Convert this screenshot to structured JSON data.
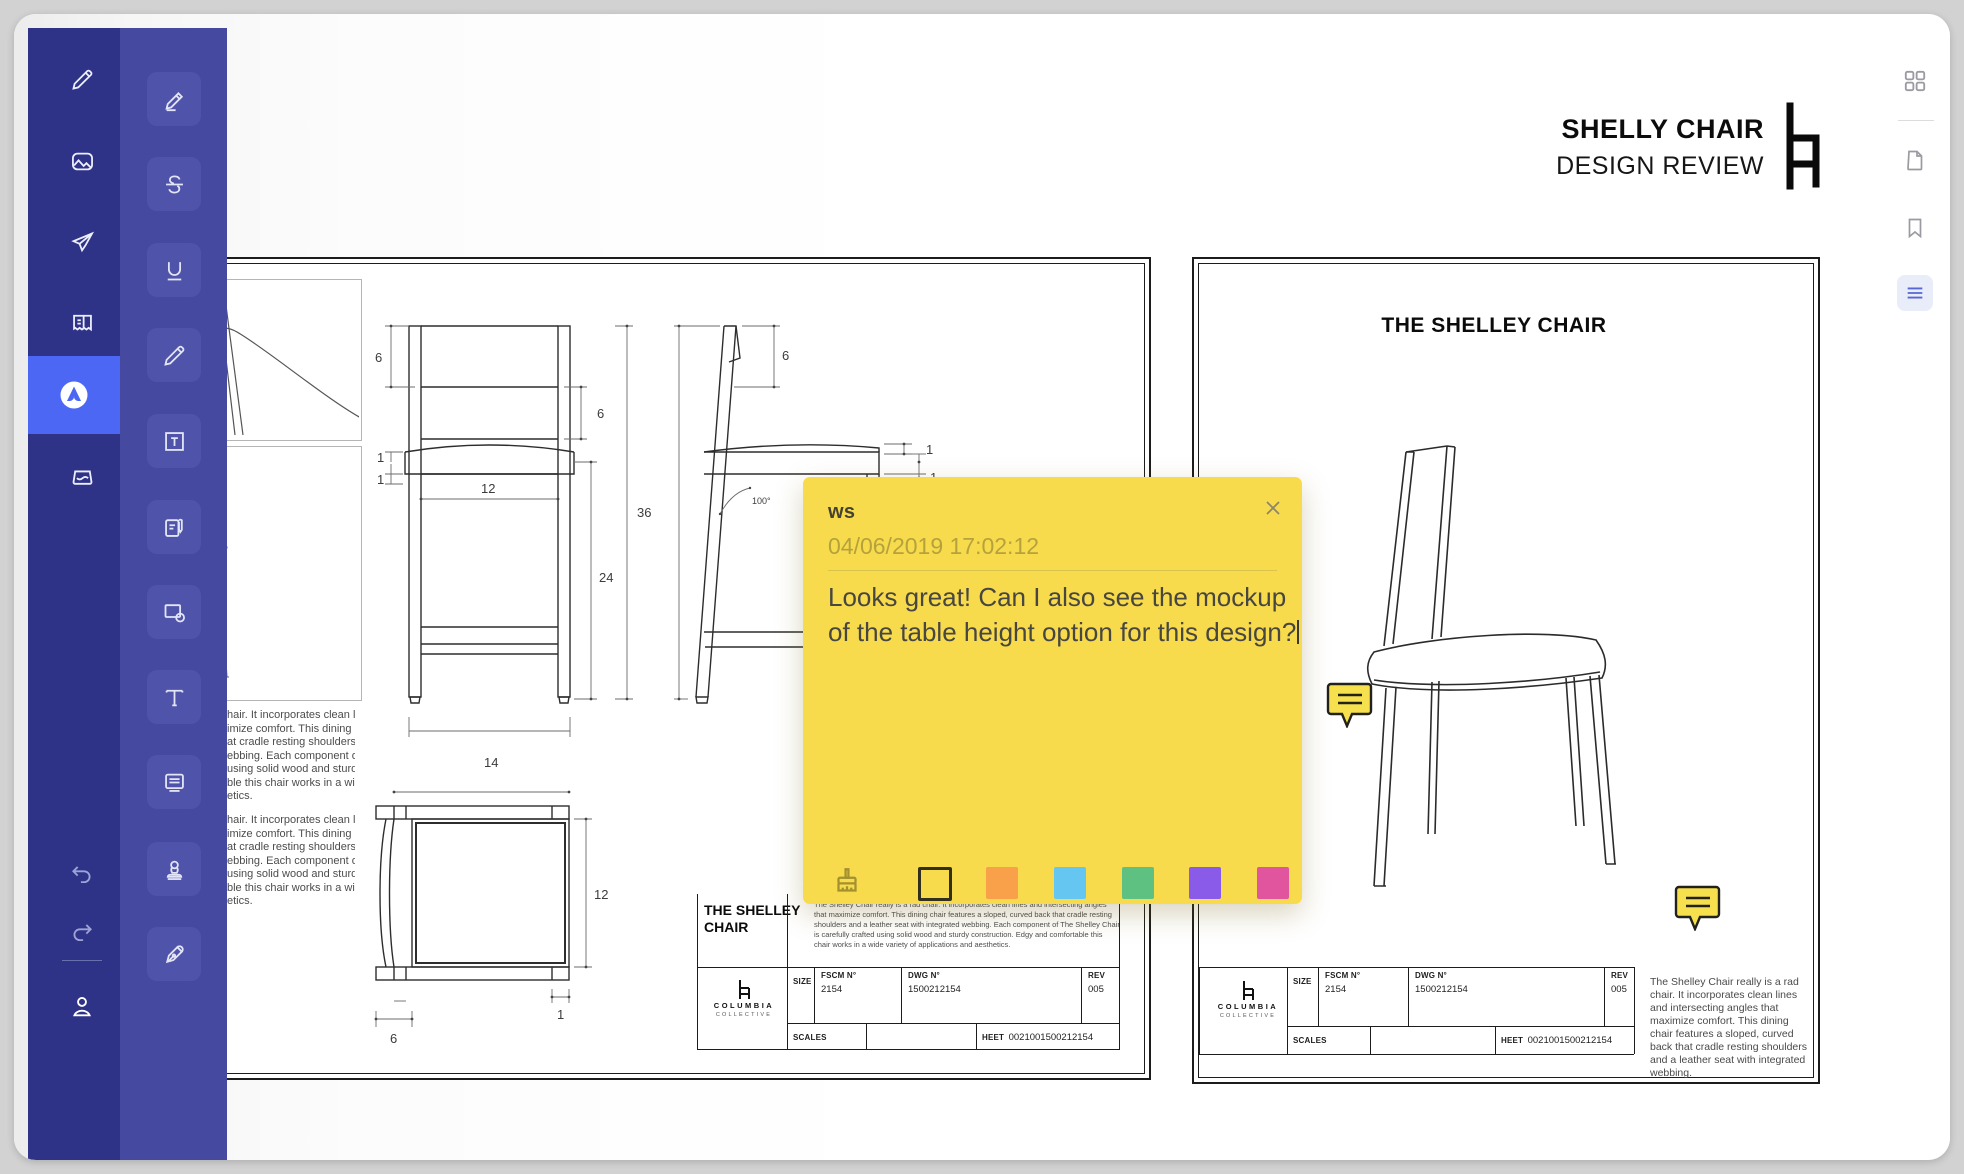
{
  "header": {
    "title": "SHELLY CHAIR",
    "subtitle": "DESIGN REVIEW"
  },
  "note": {
    "author": "ws",
    "timestamp": "04/06/2019 17:02:12",
    "body_line1": "Looks great! Can I also see the mockup",
    "body_line2": "of the table height option for this design?",
    "colors": {
      "note": "#F7DB4D",
      "orange": "#F9A04B",
      "blue": "#66C6F2",
      "green": "#5EC081",
      "purple": "#8A5BE8",
      "pink": "#E0559E"
    }
  },
  "sheets": {
    "right_title": "THE SHELLEY CHAIR",
    "front_dims": {
      "top": "6",
      "back": "6",
      "seat1": "1",
      "seat2": "1",
      "width": "12",
      "leg": "24",
      "height": "36",
      "base": "14"
    },
    "side_dims": {
      "top": "6",
      "one_a": "1",
      "one_b": "1",
      "angle": "100°"
    },
    "top_dims": {
      "depth": "12",
      "edge": "1",
      "back": "6"
    },
    "left_paragraph_lines": {
      "0": "hair. It incorporates clean lines",
      "1": "imize comfort. This dining chair",
      "2": "at cradle resting shoulders and",
      "3": "ebbing. Each component of The",
      "4": "using solid wood and sturdy",
      "5": "ble this chair works in a wide",
      "6": "etics."
    },
    "block": {
      "title": "THE SHELLEY CHAIR",
      "description": "The Shelley Chair really is a rad chair. It incorporates clean lines and intersecting angles that maximize comfort. This dining chair features a sloped, curved back that cradle resting shoulders and a leather seat with integrated webbing. Each component of The Shelley Chair is carefully crafted using solid wood and sturdy construction. Edgy and comfortable this chair works in a wide variety of applications and aesthetics.",
      "brand_line1": "COLUMBIA",
      "brand_line2": "COLLECTIVE",
      "size_label": "SIZE",
      "fscm_label": "FSCM N°",
      "fscm_value": "2154",
      "dwg_label": "DWG N°",
      "dwg_value": "1500212154",
      "rev_label": "REV",
      "rev_value": "005",
      "scales_label": "SCALES",
      "sheet_label": "HEET",
      "sheet_value": "0021001500212154"
    },
    "right_description": "The Shelley Chair really is a rad chair. It incorporates clean lines and intersecting angles that maximize comfort. This dining chair features a sloped, curved back that cradle resting shoulders and a leather seat with integrated webbing."
  }
}
